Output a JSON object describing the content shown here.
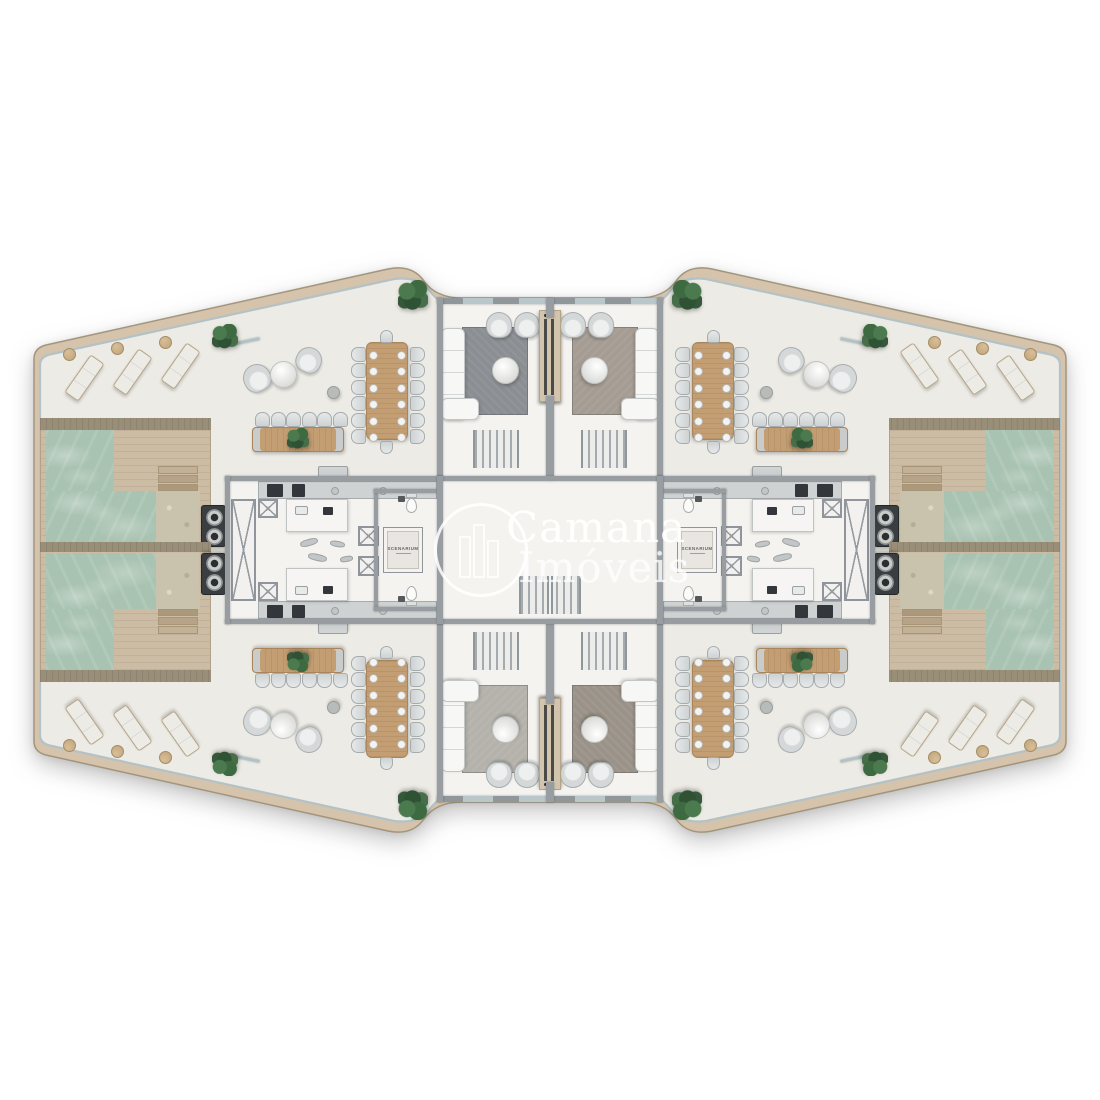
{
  "watermark": {
    "brand_top": "Camana",
    "brand_bottom": "Imóveis",
    "logo": "building-logo-icon"
  },
  "floor_plaques": {
    "left_hall": "SCENARIUM",
    "right_hall": "SCENARIUM"
  },
  "colors": {
    "background": "#ffffff",
    "terrace_floor": "#edebe5",
    "interior_floor": "#f4f3f0",
    "wall_gray": "#979da1",
    "edge_band_beige": "#d5c4ab",
    "glass_railing": "#b3c2c6",
    "pool_water": "#a9c3b2",
    "pool_ledge_sand": "#c9c2ac",
    "deck_tan": "#cdbca4",
    "wood_table": "#c49e73",
    "rug_top_left": "#8b8e92",
    "rug_top_right": "#a59d93",
    "rug_bottom_left": "#b5b2ac",
    "rug_bottom_right": "#9b9389",
    "plant_green": "#3e6a42",
    "appliance_dark": "#33363a",
    "watermark_white": "rgba(255,255,255,0.85)"
  }
}
